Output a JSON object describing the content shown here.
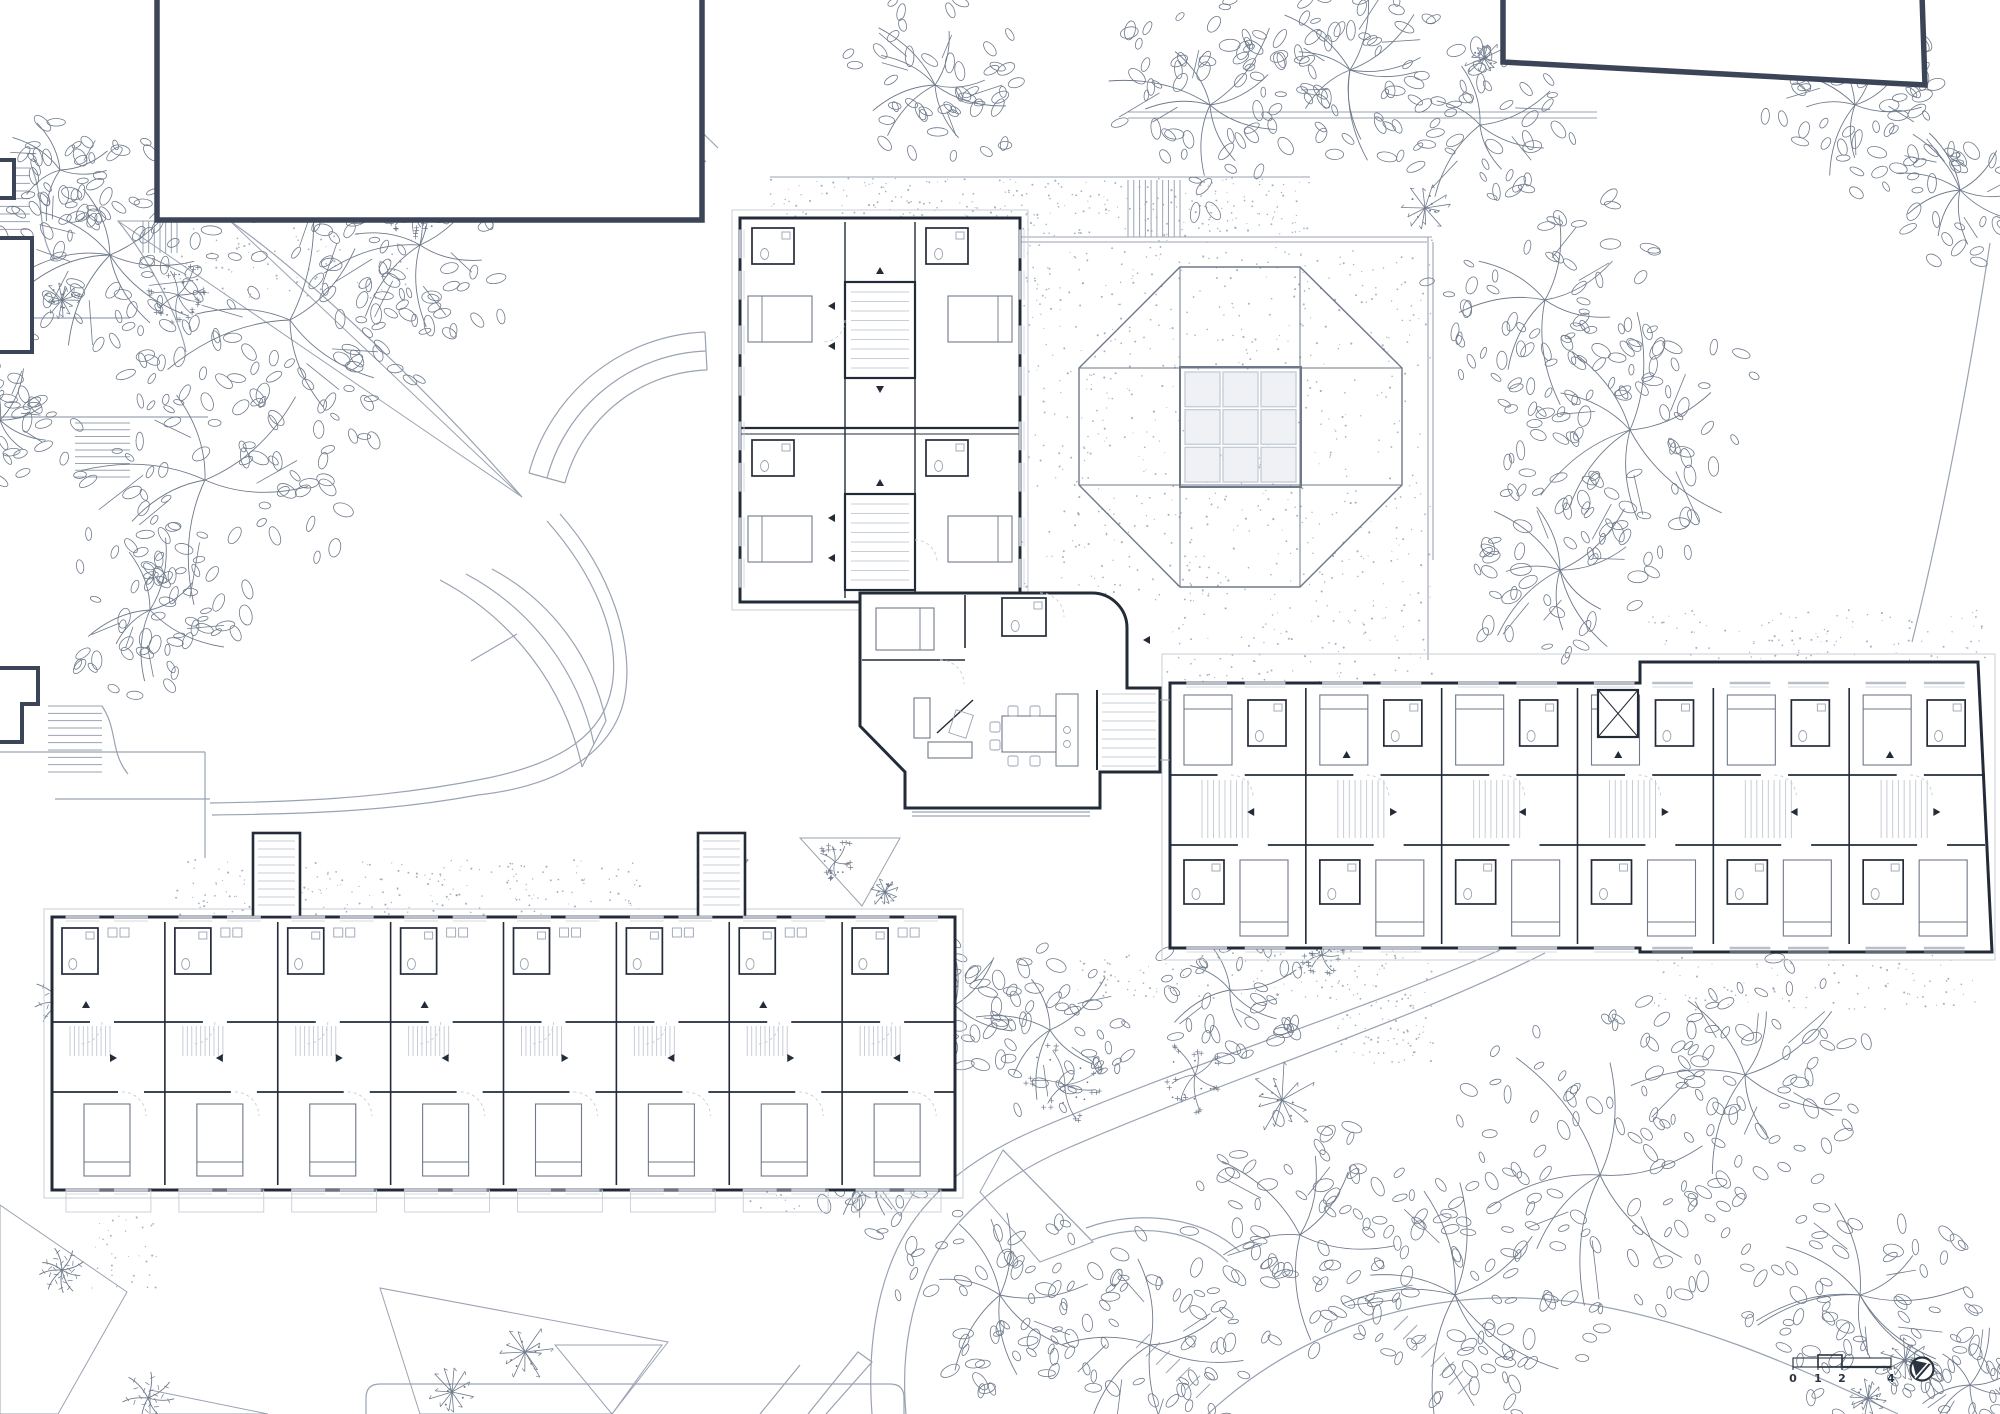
{
  "meta": {
    "canvas_width": 2000,
    "canvas_height": 1414,
    "drawing_type": "architectural-site-floor-plan"
  },
  "colors": {
    "paper": "#ffffff",
    "wall": "#232b38",
    "dark_outline": "#3c4557",
    "medium": "#6e7889",
    "light": "#9aa3b2",
    "xlight": "#c7cdd7",
    "leaf": "#6f7a8b",
    "dot": "#8d96a6",
    "skylight_fill": "#f0f1f5",
    "text": "#2a3340"
  },
  "annotations": {
    "scale_bar": {
      "ticks": [
        {
          "label": "0",
          "x": 1793
        },
        {
          "label": "1",
          "x": 1818
        },
        {
          "label": "2",
          "x": 1842
        },
        {
          "label": "4",
          "x": 1891
        }
      ],
      "bar_y": 1358,
      "bar_h": 9,
      "box_x1": 1818,
      "box_x2": 1842,
      "label_y": 1382
    },
    "north_arrow": {
      "cx": 1922,
      "cy": 1369,
      "r": 11.5
    }
  },
  "plaza": {
    "stipple_poly": [
      [
        1020,
        240
      ],
      [
        1432,
        240
      ],
      [
        1432,
        686
      ],
      [
        1167,
        686
      ],
      [
        1167,
        602
      ],
      [
        1020,
        602
      ]
    ],
    "octagon": [
      [
        1180,
        267
      ],
      [
        1300,
        267
      ],
      [
        1402,
        368
      ],
      [
        1402,
        485
      ],
      [
        1300,
        587
      ],
      [
        1180,
        587
      ],
      [
        1079,
        485
      ],
      [
        1079,
        368
      ]
    ],
    "band_v": [
      1180,
      1300
    ],
    "band_h": [
      368,
      485
    ],
    "skylight": {
      "x": 1185,
      "y": 372,
      "w": 111,
      "h": 110,
      "rows": 3,
      "cols": 3
    },
    "border_lines": [
      "M770,237 H1432",
      "M770,242 H1427",
      "M1428,237 V660",
      "M1433,242 V560",
      "M770,177 H1310",
      "M1128,112 H1597",
      "M1128,118 H1597"
    ],
    "band_stair": {
      "x": 1128,
      "y": 180,
      "w": 52,
      "h": 57,
      "n": 9
    }
  },
  "gravel_patches": [
    {
      "rect": [
        770,
        178,
        540,
        58
      ],
      "density": 0.01
    },
    {
      "poly": [
        [
          1020,
          240
        ],
        [
          1432,
          240
        ],
        [
          1432,
          686
        ],
        [
          1167,
          686
        ],
        [
          1167,
          602
        ],
        [
          1020,
          602
        ]
      ],
      "density": 0.0045
    },
    {
      "rect": [
        175,
        860,
        465,
        55
      ],
      "density": 0.008
    },
    {
      "rect": [
        748,
        1078,
        90,
        135
      ],
      "density": 0.007
    },
    {
      "rect": [
        1075,
        952,
        258,
        48
      ],
      "density": 0.007
    },
    {
      "rect": [
        1333,
        950,
        100,
        115
      ],
      "density": 0.009
    },
    {
      "rect": [
        1648,
        610,
        342,
        50
      ],
      "density": 0.006
    },
    {
      "rect": [
        1648,
        955,
        330,
        55
      ],
      "density": 0.005
    },
    {
      "rect": [
        90,
        1212,
        70,
        80
      ],
      "density": 0.006
    },
    {
      "rect": [
        175,
        228,
        240,
        70
      ],
      "density": 0.005
    }
  ],
  "site": {
    "paths": [
      "M575,0 C596,46 646,108 706,162",
      "M601,0 C620,38 662,94 718,148",
      "M230,221 C300,270 420,380 522,497",
      "M118,221 C150,260 180,320 186,352",
      "M565,483 A152,152 0 0 1 707,370",
      "M547,478 A171,171 0 0 1 706,351",
      "M529,473 A190,190 0 0 1 705,332",
      "M565,483 L529,473",
      "M707,370 L705,332",
      "M606,721 A225,225 0 0 0 492,569",
      "M594,744 A252,252 0 0 0 466,574",
      "M582,767 A278,278 0 0 0 440,580",
      "M517,634 L471,661",
      "M606,721 L582,767",
      "M547,521 C592,572 621,634 612,686 C604,733 564,762 488,778 C380,800 280,802 210,803",
      "M560,514 C610,570 636,645 624,700 C612,752 560,786 478,795 C386,812 300,814 212,815",
      "M55,799 H210",
      "M0,752 H205",
      "M205,752 V858",
      "M1500,950 C1370,1008 1205,1058 1040,1128 C968,1158 917,1200 893,1258 C873,1306 868,1362 872,1414",
      "M1545,953 C1408,1022 1238,1075 1068,1148 C998,1178 947,1222 925,1276 C906,1322 902,1370 906,1414",
      "M1208,1414 C1296,1332 1420,1287 1556,1300 C1678,1312 1800,1368 1898,1414",
      "M1092,1240 C1140,1222 1196,1230 1228,1262",
      "M1086,1228 C1140,1208 1206,1218 1240,1252",
      "M1003,1150 L1093,1242",
      "M808,1414 L858,1352 L872,1362 L826,1414",
      "M760,1414 L800,1365",
      "M1990,243 C1973,352 1948,498 1912,642",
      "M366,1414 V1398 Q366,1384 380,1384 H890 Q904,1384 904,1398 V1414",
      "M30,240 V318 H130",
      "M0,417 H208",
      "M32,168 C46,204 36,232 54,260",
      "M102,706 C118,730 110,752 128,774",
      "M912,812 H1090",
      "M912,816 H1090"
    ],
    "stairs": [
      {
        "x": 0,
        "y": 168,
        "w": 30,
        "h": 92,
        "n": 12,
        "dir": "h"
      },
      {
        "x": 75,
        "y": 423,
        "w": 55,
        "h": 54,
        "n": 8,
        "dir": "h"
      },
      {
        "x": 48,
        "y": 706,
        "w": 54,
        "h": 66,
        "n": 9,
        "dir": "h"
      },
      {
        "x": 143,
        "y": 221,
        "w": 34,
        "h": 32,
        "n": 6,
        "dir": "v"
      },
      {
        "x": 556,
        "y": 8,
        "w": 50,
        "h": 54,
        "n": 8,
        "dir": "h"
      },
      {
        "x": 1408,
        "y": 1330,
        "w": 64,
        "h": 64,
        "n": 7,
        "dir": "d"
      },
      {
        "x": 1150,
        "y": 1348,
        "w": 60,
        "h": 50,
        "n": 6,
        "dir": "d"
      }
    ],
    "beds": [
      [
        [
          118,
          221
        ],
        [
          522,
          497
        ],
        [
          230,
          221
        ]
      ],
      [
        [
          800,
          838
        ],
        [
          900,
          838
        ],
        [
          862,
          906
        ]
      ],
      [
        [
          855,
          1152
        ],
        [
          938,
          1152
        ],
        [
          900,
          1216
        ]
      ],
      [
        [
          555,
          1345
        ],
        [
          662,
          1345
        ],
        [
          612,
          1414
        ]
      ],
      [
        [
          0,
          1205
        ],
        [
          127,
          1292
        ],
        [
          58,
          1414
        ],
        [
          0,
          1414
        ]
      ],
      [
        [
          380,
          1288
        ],
        [
          668,
          1342
        ],
        [
          612,
          1414
        ],
        [
          420,
          1414
        ]
      ],
      [
        [
          150,
          1390
        ],
        [
          268,
          1414
        ],
        [
          150,
          1414
        ]
      ],
      [
        [
          1003,
          1150
        ],
        [
          1093,
          1242
        ],
        [
          1040,
          1262
        ],
        [
          980,
          1192
        ]
      ]
    ]
  },
  "vegetation": {
    "trees": [
      {
        "x": 110,
        "y": 255,
        "r": 115,
        "t": "leafy"
      },
      {
        "x": 290,
        "y": 320,
        "r": 150,
        "t": "leafy"
      },
      {
        "x": 205,
        "y": 480,
        "r": 135,
        "t": "leafy"
      },
      {
        "x": 420,
        "y": 245,
        "r": 105,
        "t": "leafy"
      },
      {
        "x": 150,
        "y": 610,
        "r": 85,
        "t": "leafy"
      },
      {
        "x": 935,
        "y": 85,
        "r": 85,
        "t": "leafy"
      },
      {
        "x": 1210,
        "y": 105,
        "r": 105,
        "t": "leafy"
      },
      {
        "x": 1350,
        "y": 70,
        "r": 95,
        "t": "leafy"
      },
      {
        "x": 1480,
        "y": 125,
        "r": 85,
        "t": "leafy"
      },
      {
        "x": 1545,
        "y": 300,
        "r": 115,
        "t": "leafy"
      },
      {
        "x": 1630,
        "y": 430,
        "r": 125,
        "t": "leafy"
      },
      {
        "x": 1560,
        "y": 570,
        "r": 95,
        "t": "leafy"
      },
      {
        "x": 1855,
        "y": 105,
        "r": 85,
        "t": "leafy"
      },
      {
        "x": 1960,
        "y": 190,
        "r": 75,
        "t": "leafy"
      },
      {
        "x": 1600,
        "y": 1175,
        "r": 150,
        "t": "leafy"
      },
      {
        "x": 1745,
        "y": 1075,
        "r": 120,
        "t": "leafy"
      },
      {
        "x": 1455,
        "y": 1295,
        "r": 130,
        "t": "leafy"
      },
      {
        "x": 1300,
        "y": 1235,
        "r": 110,
        "t": "leafy"
      },
      {
        "x": 1860,
        "y": 1295,
        "r": 115,
        "t": "leafy"
      },
      {
        "x": 1150,
        "y": 1345,
        "r": 115,
        "t": "leafy"
      },
      {
        "x": 1000,
        "y": 1295,
        "r": 95,
        "t": "leafy"
      },
      {
        "x": 1050,
        "y": 1030,
        "r": 80,
        "t": "leafy"
      },
      {
        "x": 955,
        "y": 1005,
        "r": 70,
        "t": "leafy"
      },
      {
        "x": 1230,
        "y": 990,
        "r": 70,
        "t": "leafy"
      },
      {
        "x": 1970,
        "y": 1385,
        "r": 70,
        "t": "leafy"
      },
      {
        "x": 875,
        "y": 1175,
        "r": 55,
        "t": "leafy"
      },
      {
        "x": 60,
        "y": 170,
        "r": 60,
        "t": "leafy"
      },
      {
        "x": 0,
        "y": 420,
        "r": 60,
        "t": "leafy"
      },
      {
        "x": 62,
        "y": 300,
        "r": 20,
        "t": "shrub"
      },
      {
        "x": 1425,
        "y": 208,
        "r": 26,
        "t": "shrub"
      },
      {
        "x": 1484,
        "y": 58,
        "r": 22,
        "t": "shrub"
      },
      {
        "x": 1065,
        "y": 1085,
        "r": 40,
        "t": "flower"
      },
      {
        "x": 1195,
        "y": 1075,
        "r": 35,
        "t": "flower"
      },
      {
        "x": 1282,
        "y": 1100,
        "r": 40,
        "t": "shrub"
      },
      {
        "x": 525,
        "y": 1352,
        "r": 30,
        "t": "shrub"
      },
      {
        "x": 452,
        "y": 1392,
        "r": 26,
        "t": "shrub"
      },
      {
        "x": 835,
        "y": 862,
        "r": 20,
        "t": "flower"
      },
      {
        "x": 885,
        "y": 892,
        "r": 16,
        "t": "shrub"
      },
      {
        "x": 62,
        "y": 1002,
        "r": 30,
        "t": "palm"
      },
      {
        "x": 100,
        "y": 1040,
        "r": 22,
        "t": "shrub"
      },
      {
        "x": 205,
        "y": 1125,
        "r": 18,
        "t": "shrub"
      },
      {
        "x": 62,
        "y": 1270,
        "r": 22,
        "t": "palm"
      },
      {
        "x": 1905,
        "y": 1360,
        "r": 26,
        "t": "shrub"
      },
      {
        "x": 1868,
        "y": 1398,
        "r": 20,
        "t": "shrub"
      },
      {
        "x": 735,
        "y": 862,
        "r": 16,
        "t": "shrub"
      },
      {
        "x": 178,
        "y": 295,
        "r": 30,
        "t": "flower"
      },
      {
        "x": 415,
        "y": 212,
        "r": 24,
        "t": "flower"
      },
      {
        "x": 870,
        "y": 1162,
        "r": 22,
        "t": "flower"
      },
      {
        "x": 148,
        "y": 1398,
        "r": 26,
        "t": "palm"
      },
      {
        "x": 1322,
        "y": 955,
        "r": 20,
        "t": "flower"
      }
    ]
  },
  "buildings": {
    "existing": [
      {
        "kind": "rect",
        "x": 157,
        "y": -8,
        "w": 545,
        "h": 228
      },
      {
        "kind": "poly",
        "pts": [
          [
            1503,
            -5
          ],
          [
            1922,
            -5
          ],
          [
            1925,
            85
          ],
          [
            1503,
            62
          ]
        ]
      },
      {
        "kind": "path",
        "d": "M0,160 H14 V198 H0"
      },
      {
        "kind": "path",
        "d": "M0,238 H32 V352 H0"
      },
      {
        "kind": "path",
        "d": "M0,668 H38 V704 H22 V742 H0"
      }
    ],
    "south": {
      "x": 52,
      "y": 917,
      "w": 903,
      "h": 273,
      "modules": 8,
      "towers": [
        {
          "x": 253,
          "y": 833,
          "w": 47,
          "h": 84
        },
        {
          "x": 698,
          "y": 833,
          "w": 47,
          "h": 84
        }
      ]
    },
    "east": {
      "x": 1170,
      "y": 683,
      "w": 815,
      "h": 265,
      "modules": 6,
      "outline": "M1170,683 H1640 V662 H1978 L1992,952 H1640 V948 H1170 Z",
      "elevator": {
        "x": 1598,
        "y": 690,
        "w": 40,
        "h": 47
      }
    },
    "north": {
      "x": 740,
      "y": 218,
      "w": 280,
      "h": 384,
      "cores": [
        {
          "x": 845,
          "y": 282,
          "w": 70,
          "h": 96
        },
        {
          "x": 845,
          "y": 494,
          "w": 70,
          "h": 96
        }
      ]
    },
    "wing": {
      "outline": "M860,593 H1092 A35,35 0 0 1 1127,628 V688 H1160 V772 H1100 V808 H905 V772 L860,726 Z"
    }
  }
}
